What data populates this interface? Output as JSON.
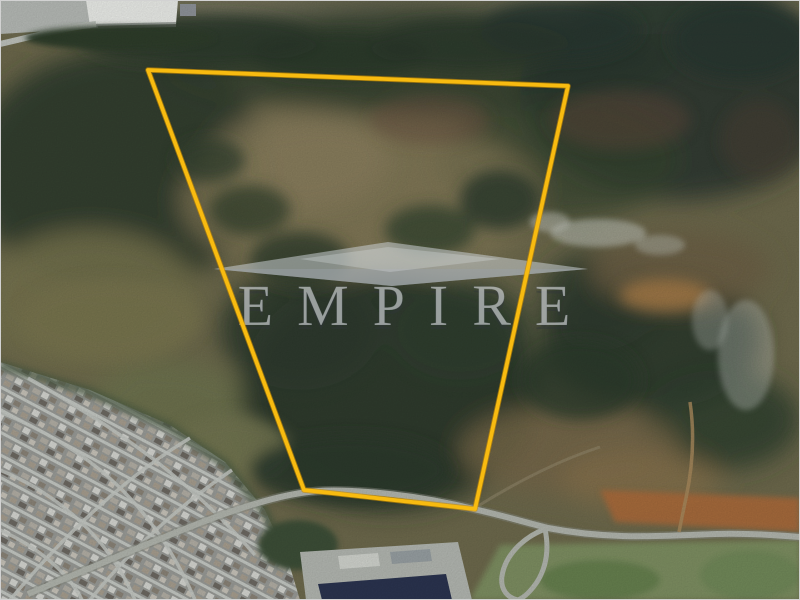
{
  "watermark": {
    "text": "EMPIRE",
    "logo_icon": "diamond-gem-logo-icon",
    "color": "#dde1e4"
  },
  "boundary": {
    "points": "148,70 568,86 475,509 304,490",
    "color": "#f8bb10"
  }
}
